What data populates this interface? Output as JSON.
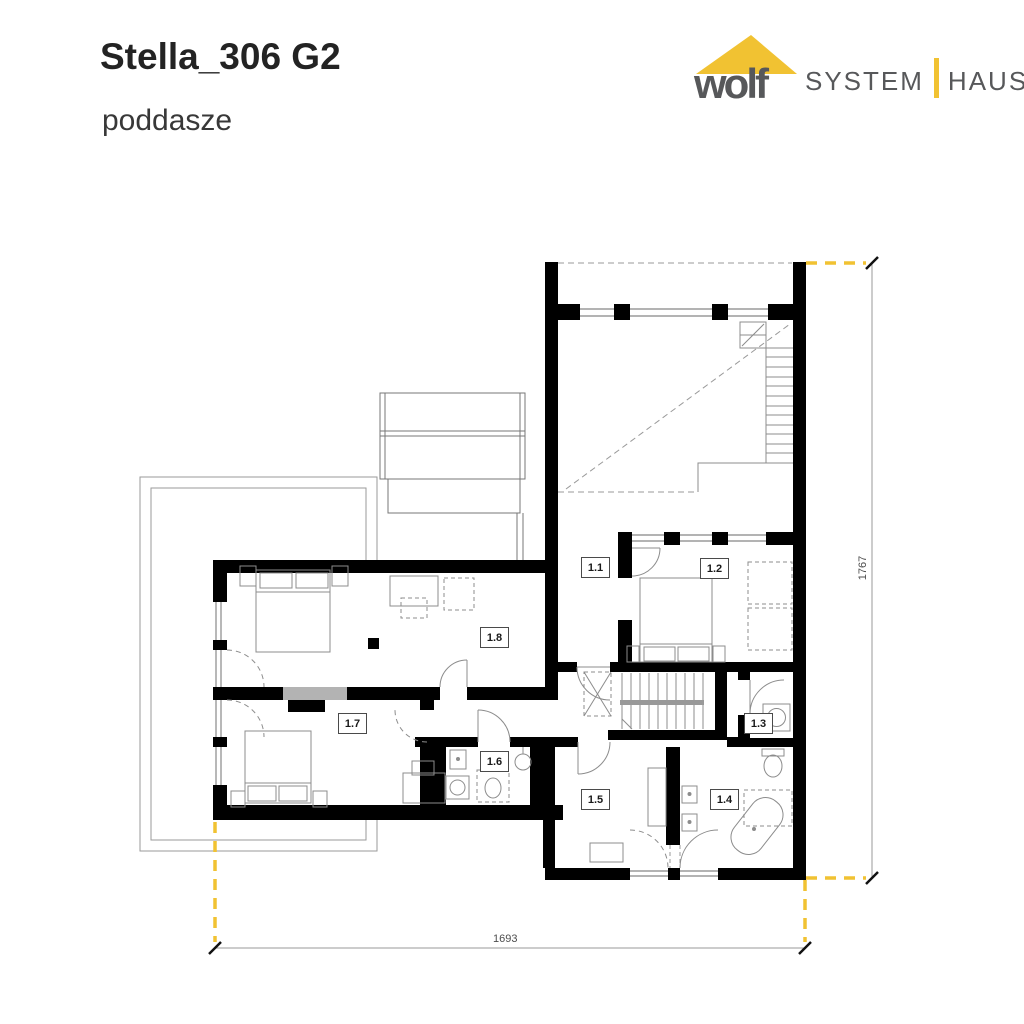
{
  "header": {
    "title": "Stella_306 G2",
    "subtitle": "poddasze"
  },
  "logo": {
    "word": "wolf",
    "system": "SYSTEM",
    "haus": "HAUS",
    "colors": {
      "yellow": "#f1c232",
      "gray": "#57585a"
    }
  },
  "plan": {
    "rooms": [
      {
        "id": "1.1"
      },
      {
        "id": "1.2"
      },
      {
        "id": "1.3"
      },
      {
        "id": "1.4"
      },
      {
        "id": "1.5"
      },
      {
        "id": "1.6"
      },
      {
        "id": "1.7"
      },
      {
        "id": "1.8"
      }
    ],
    "dimensions": {
      "width_label": "1693",
      "height_label": "1767"
    },
    "colors": {
      "wall": "#000000",
      "thin_line": "#8c8c8c",
      "accent_yellow": "#f1c232"
    }
  }
}
